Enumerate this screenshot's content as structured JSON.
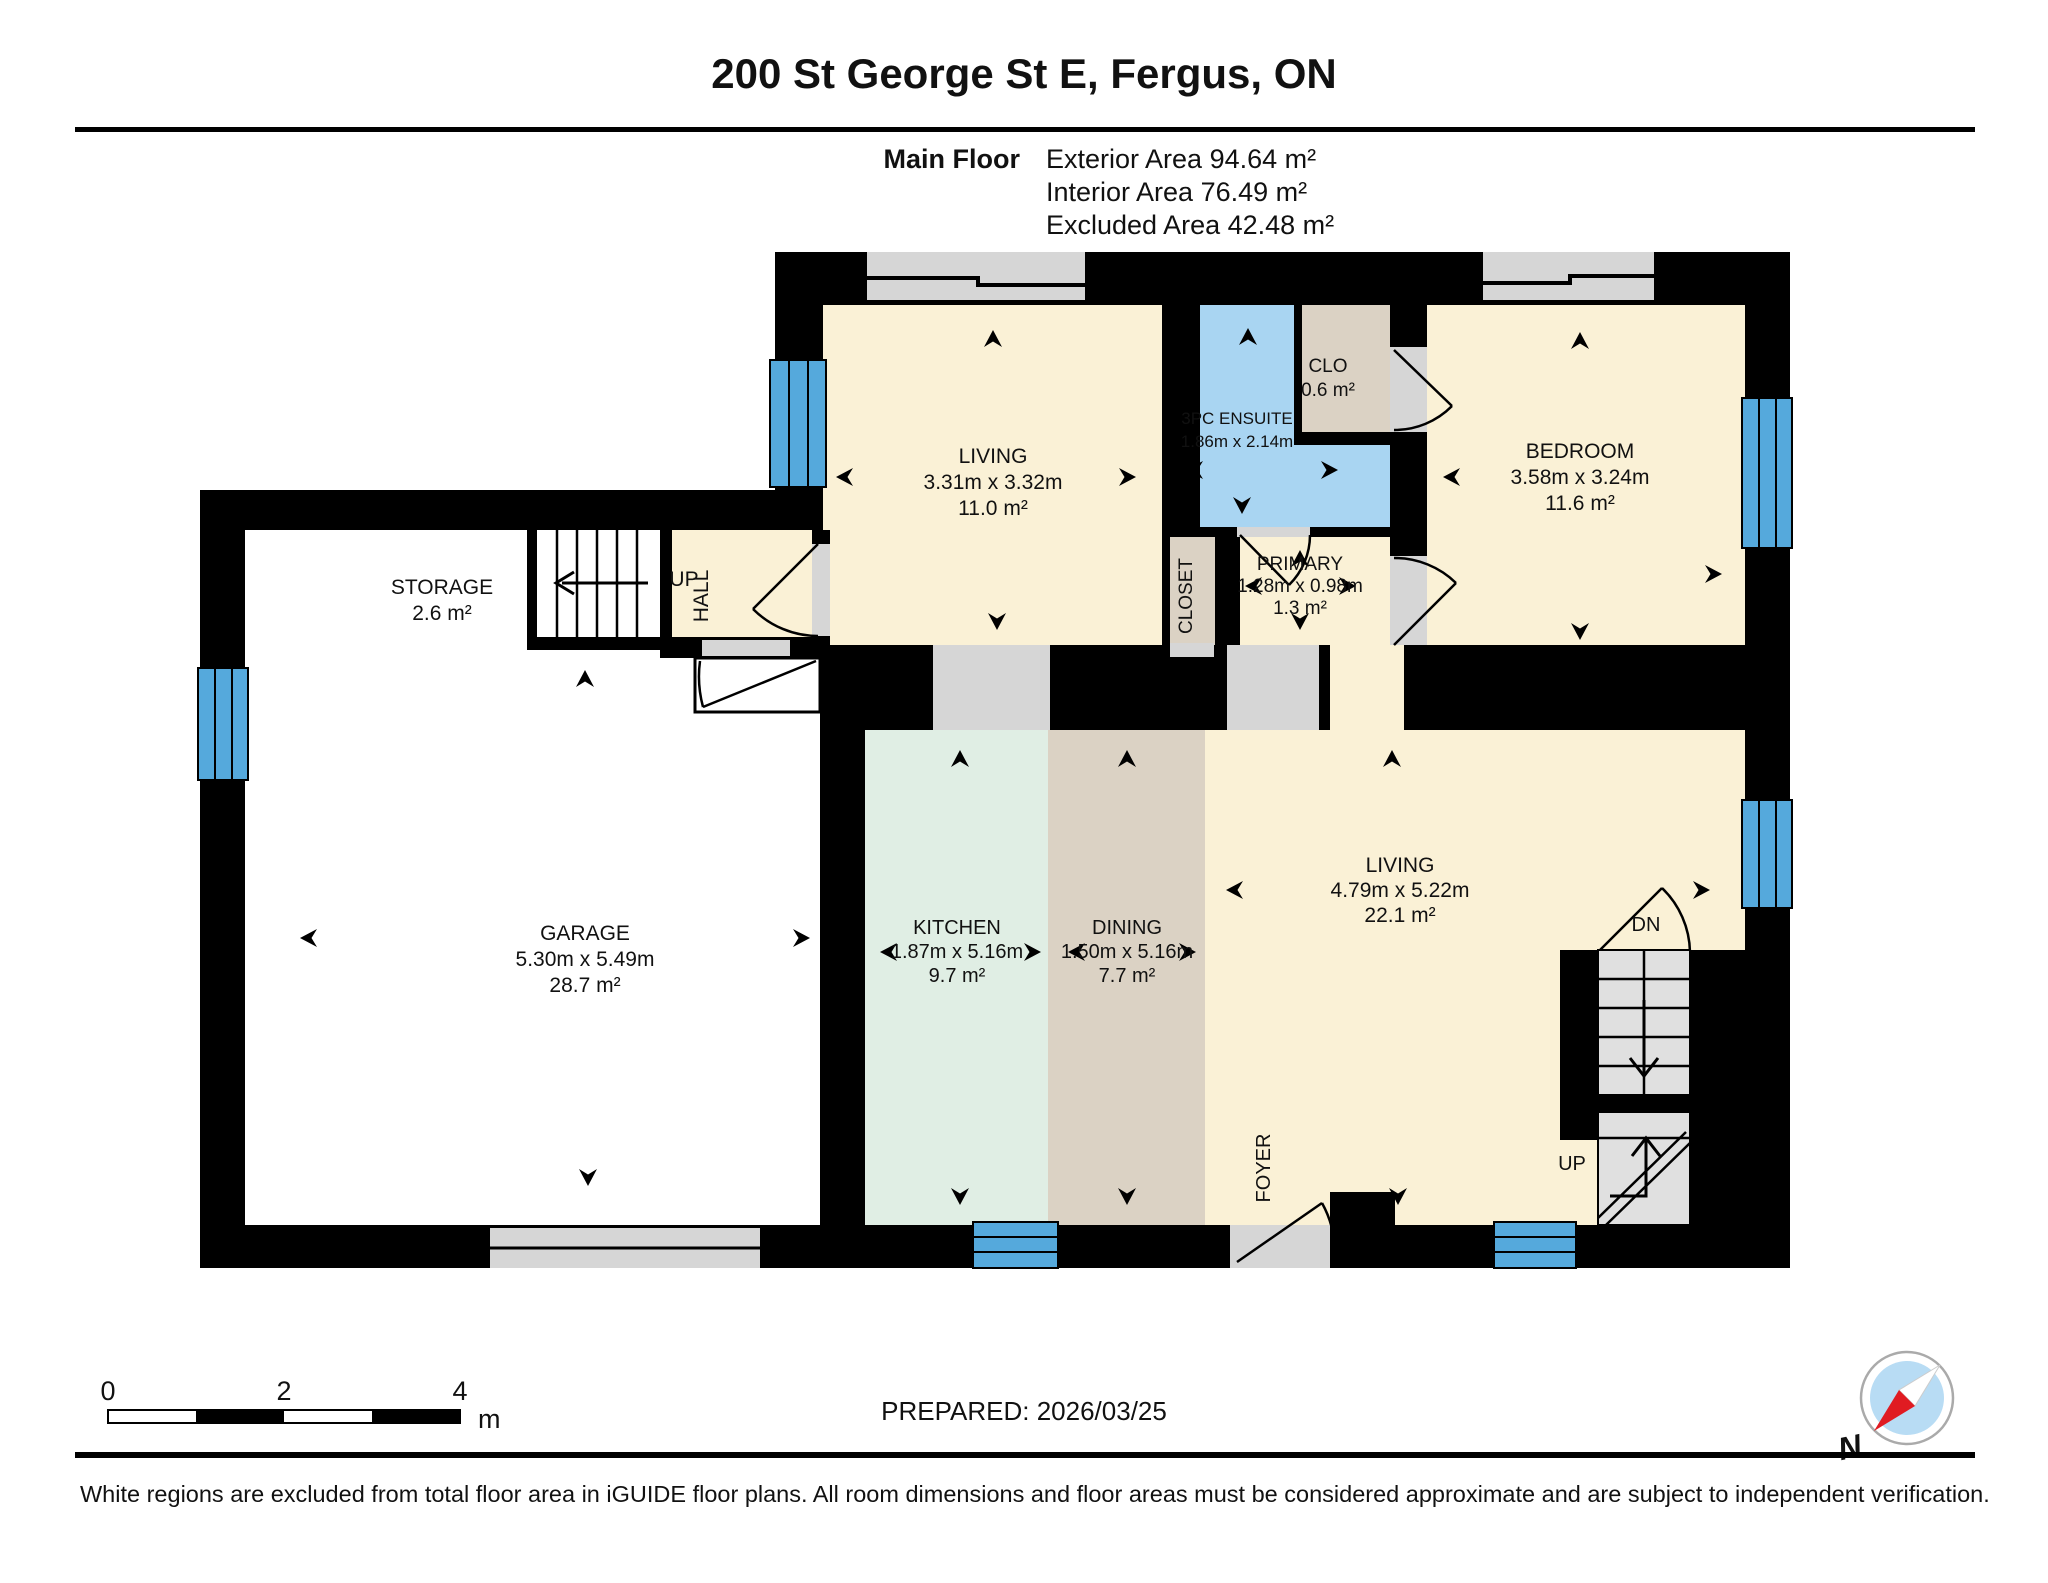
{
  "header": {
    "title": "200 St George St E, Fergus, ON",
    "floor_label": "Main Floor",
    "exterior_area": "Exterior Area 94.64 m²",
    "interior_area": "Interior Area 76.49 m²",
    "excluded_area": "Excluded Area 42.48 m²"
  },
  "rooms": {
    "living_upper": {
      "name": "LIVING",
      "dims": "3.31m x 3.32m",
      "area": "11.0 m²"
    },
    "ensuite": {
      "name": "3PC ENSUITE",
      "dims": "1.86m x 2.14m"
    },
    "clo": {
      "name": "CLO",
      "area": "0.6 m²"
    },
    "bedroom": {
      "name": "BEDROOM",
      "dims": "3.58m x 3.24m",
      "area": "11.6 m²"
    },
    "closet": {
      "name": "CLOSET"
    },
    "primary": {
      "name": "PRIMARY",
      "dims": "1.28m x 0.98m",
      "area": "1.3 m²"
    },
    "storage": {
      "name": "STORAGE",
      "area": "2.6 m²"
    },
    "hall": {
      "up": "UP",
      "name": "HALL"
    },
    "garage": {
      "name": "GARAGE",
      "dims": "5.30m x 5.49m",
      "area": "28.7 m²"
    },
    "kitchen": {
      "name": "KITCHEN",
      "dims": "1.87m x 5.16m",
      "area": "9.7 m²"
    },
    "dining": {
      "name": "DINING",
      "dims": "1.50m x 5.16m",
      "area": "7.7 m²"
    },
    "living_lower": {
      "name": "LIVING",
      "dims": "4.79m x 5.22m",
      "area": "22.1 m²"
    },
    "foyer": {
      "name": "FOYER"
    },
    "stairs": {
      "dn": "DN",
      "up": "UP"
    }
  },
  "scale_bar": {
    "tick0": "0",
    "tick2": "2",
    "tick4": "4",
    "unit": "m"
  },
  "footer": {
    "prepared": "PREPARED: 2026/03/25",
    "disclaimer": "White regions are excluded from total floor area in iGUIDE floor plans. All room dimensions and floor areas must be considered approximate and are subject to independent verification.",
    "compass_n": "N"
  },
  "colors": {
    "wall": "#000000",
    "room_cream": "#faf1d6",
    "bathroom_blue": "#a9d5f2",
    "window_blue": "#55a9dc",
    "closet_tan": "#dbd2c4",
    "kitchen_mint": "#e0eee4",
    "door_gray": "#d6d6d6",
    "excluded_white": "#ffffff"
  }
}
